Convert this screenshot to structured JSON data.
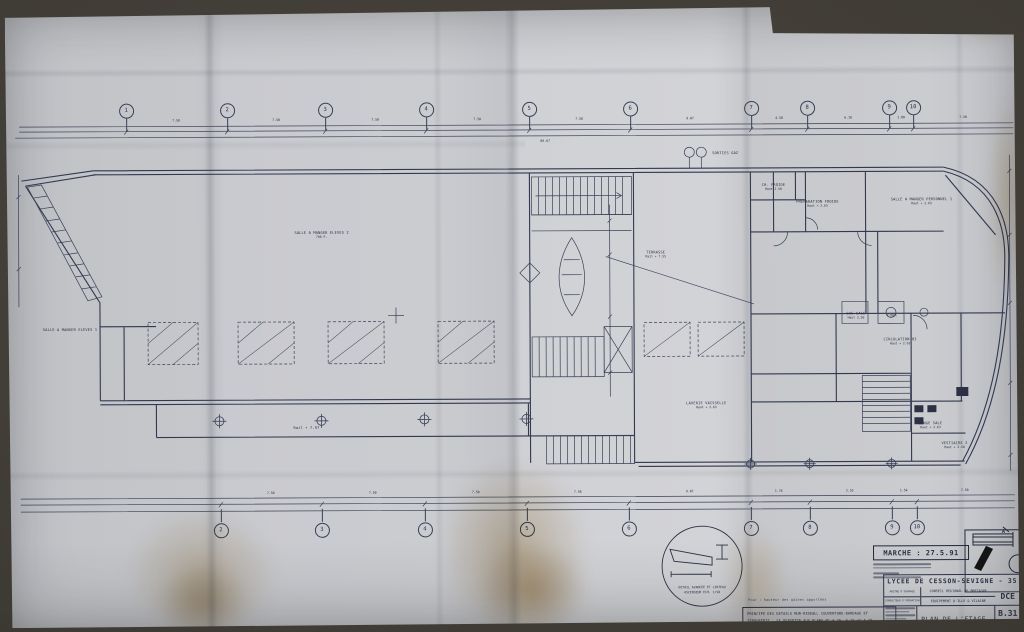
{
  "titleblock": {
    "project": "LYCEE DE CESSON-SEVIGNE - 35",
    "owner_label": "MAITRE D'OUVRAGE",
    "owner": "CONSEIL REGIONAL DE BRETAGNE",
    "conductor_label": "CONDUCTEUR D'OPERATION",
    "conductor": "EQUIPEMENT D'ILLE & VILAINE",
    "phase": "DCE",
    "title": "PLAN DE L'ETAGE.",
    "number": "B.31",
    "scale": "E 1/100"
  },
  "annotations": {
    "marche": "MARCHE : 27.5.91",
    "hand_note": "Pour : hauteur des gaines apportées",
    "note_line1": "PRINCIPE DES DETAILS MUR-RIDEAU, COUVERTURE-BARDAGE ET",
    "note_line2": "SERRURERIE : SE REPORTER AUX PLANS N° A.25, A.26 et A.28",
    "detail_caption_1": "DETAIL AVANCEE ET LINTEAU",
    "detail_caption_2": "ASCENSEUR   ECH. 1/50",
    "detail_a": "A"
  },
  "grid": {
    "top_y": 102,
    "bottom_y": 522,
    "top": [
      {
        "n": "1",
        "x": 121
      },
      {
        "n": "2",
        "x": 222
      },
      {
        "n": "3",
        "x": 320
      },
      {
        "n": "4",
        "x": 421
      },
      {
        "n": "5",
        "x": 524
      },
      {
        "n": "6",
        "x": 625
      },
      {
        "n": "7",
        "x": 746
      },
      {
        "n": "8",
        "x": 802
      },
      {
        "n": "9",
        "x": 884
      },
      {
        "n": "10",
        "x": 908
      }
    ],
    "bottom": [
      {
        "n": "2",
        "x": 214
      },
      {
        "n": "3",
        "x": 315
      },
      {
        "n": "4",
        "x": 418
      },
      {
        "n": "5",
        "x": 520
      },
      {
        "n": "6",
        "x": 622
      },
      {
        "n": "7",
        "x": 744
      },
      {
        "n": "8",
        "x": 803
      },
      {
        "n": "9",
        "x": 885
      },
      {
        "n": "10",
        "x": 910
      }
    ]
  },
  "dims": {
    "top": [
      {
        "t": "7.58",
        "x": 171
      },
      {
        "t": "7.50",
        "x": 271
      },
      {
        "t": "7.50",
        "x": 370
      },
      {
        "t": "7.50",
        "x": 472
      },
      {
        "t": "7.58",
        "x": 574
      },
      {
        "t": "9.07",
        "x": 685
      },
      {
        "t": "4.50",
        "x": 774
      },
      {
        "t": "6.10",
        "x": 843
      },
      {
        "t": "1.80",
        "x": 896
      },
      {
        "t": "7.50",
        "x": 958
      },
      {
        "t": "86.67",
        "x": 540,
        "y": 134
      }
    ],
    "bottom": [
      {
        "t": "7.50",
        "x": 264
      },
      {
        "t": "7.50",
        "x": 366
      },
      {
        "t": "7.50",
        "x": 469
      },
      {
        "t": "7.58",
        "x": 571
      },
      {
        "t": "9.07",
        "x": 683
      },
      {
        "t": "1.76",
        "x": 772
      },
      {
        "t": "2.55",
        "x": 843
      },
      {
        "t": "1.54",
        "x": 897
      },
      {
        "t": "7.50",
        "x": 958
      }
    ]
  },
  "rooms": [
    {
      "label": "SALLE A MANGER ELEVES 2",
      "sub": "700 P.",
      "x": 316,
      "y": 227
    },
    {
      "label": "SALLE A MANGER ELEVES 1",
      "sub": "",
      "x": 64,
      "y": 321
    },
    {
      "label": "TERRASSE",
      "sub": "Rail + 7.55",
      "x": 650,
      "y": 248
    },
    {
      "label": "SALLE A MANGER PERSONNEL 1",
      "sub": "Haut + 2.63",
      "x": 916,
      "y": 196
    },
    {
      "label": "PREPARATION FROIDE",
      "sub": "Haut + 2.63",
      "x": 812,
      "y": 198
    },
    {
      "label": "CH. FROIDE",
      "sub": "Haut 2.50",
      "x": 768,
      "y": 181
    },
    {
      "label": "LAVERIE VAISSELLE",
      "sub": "Haut + 2.63",
      "x": 700,
      "y": 399
    },
    {
      "label": "CIRCULATION 03",
      "sub": "Haut + 2.63",
      "x": 894,
      "y": 336
    },
    {
      "label": "VESTIAIRE 2",
      "sub": "Haut + 2.50",
      "x": 948,
      "y": 440
    },
    {
      "label": "LINGE SALE",
      "sub": "Haut + 2.63",
      "x": 924,
      "y": 420
    },
    {
      "label": "SAS SALE",
      "sub": "Haut 2.50",
      "x": 850,
      "y": 310
    },
    {
      "label": "FOUR",
      "sub": "",
      "x": 886,
      "y": 310
    },
    {
      "label": "SORTIES GAZ",
      "sub": "",
      "x": 720,
      "y": 147
    },
    {
      "label": "Rail + 7.97",
      "sub": "",
      "x": 300,
      "y": 420
    }
  ],
  "colors": {
    "ink": "#2a3042",
    "line": "#3a4157",
    "paper": "#c9cacf"
  }
}
